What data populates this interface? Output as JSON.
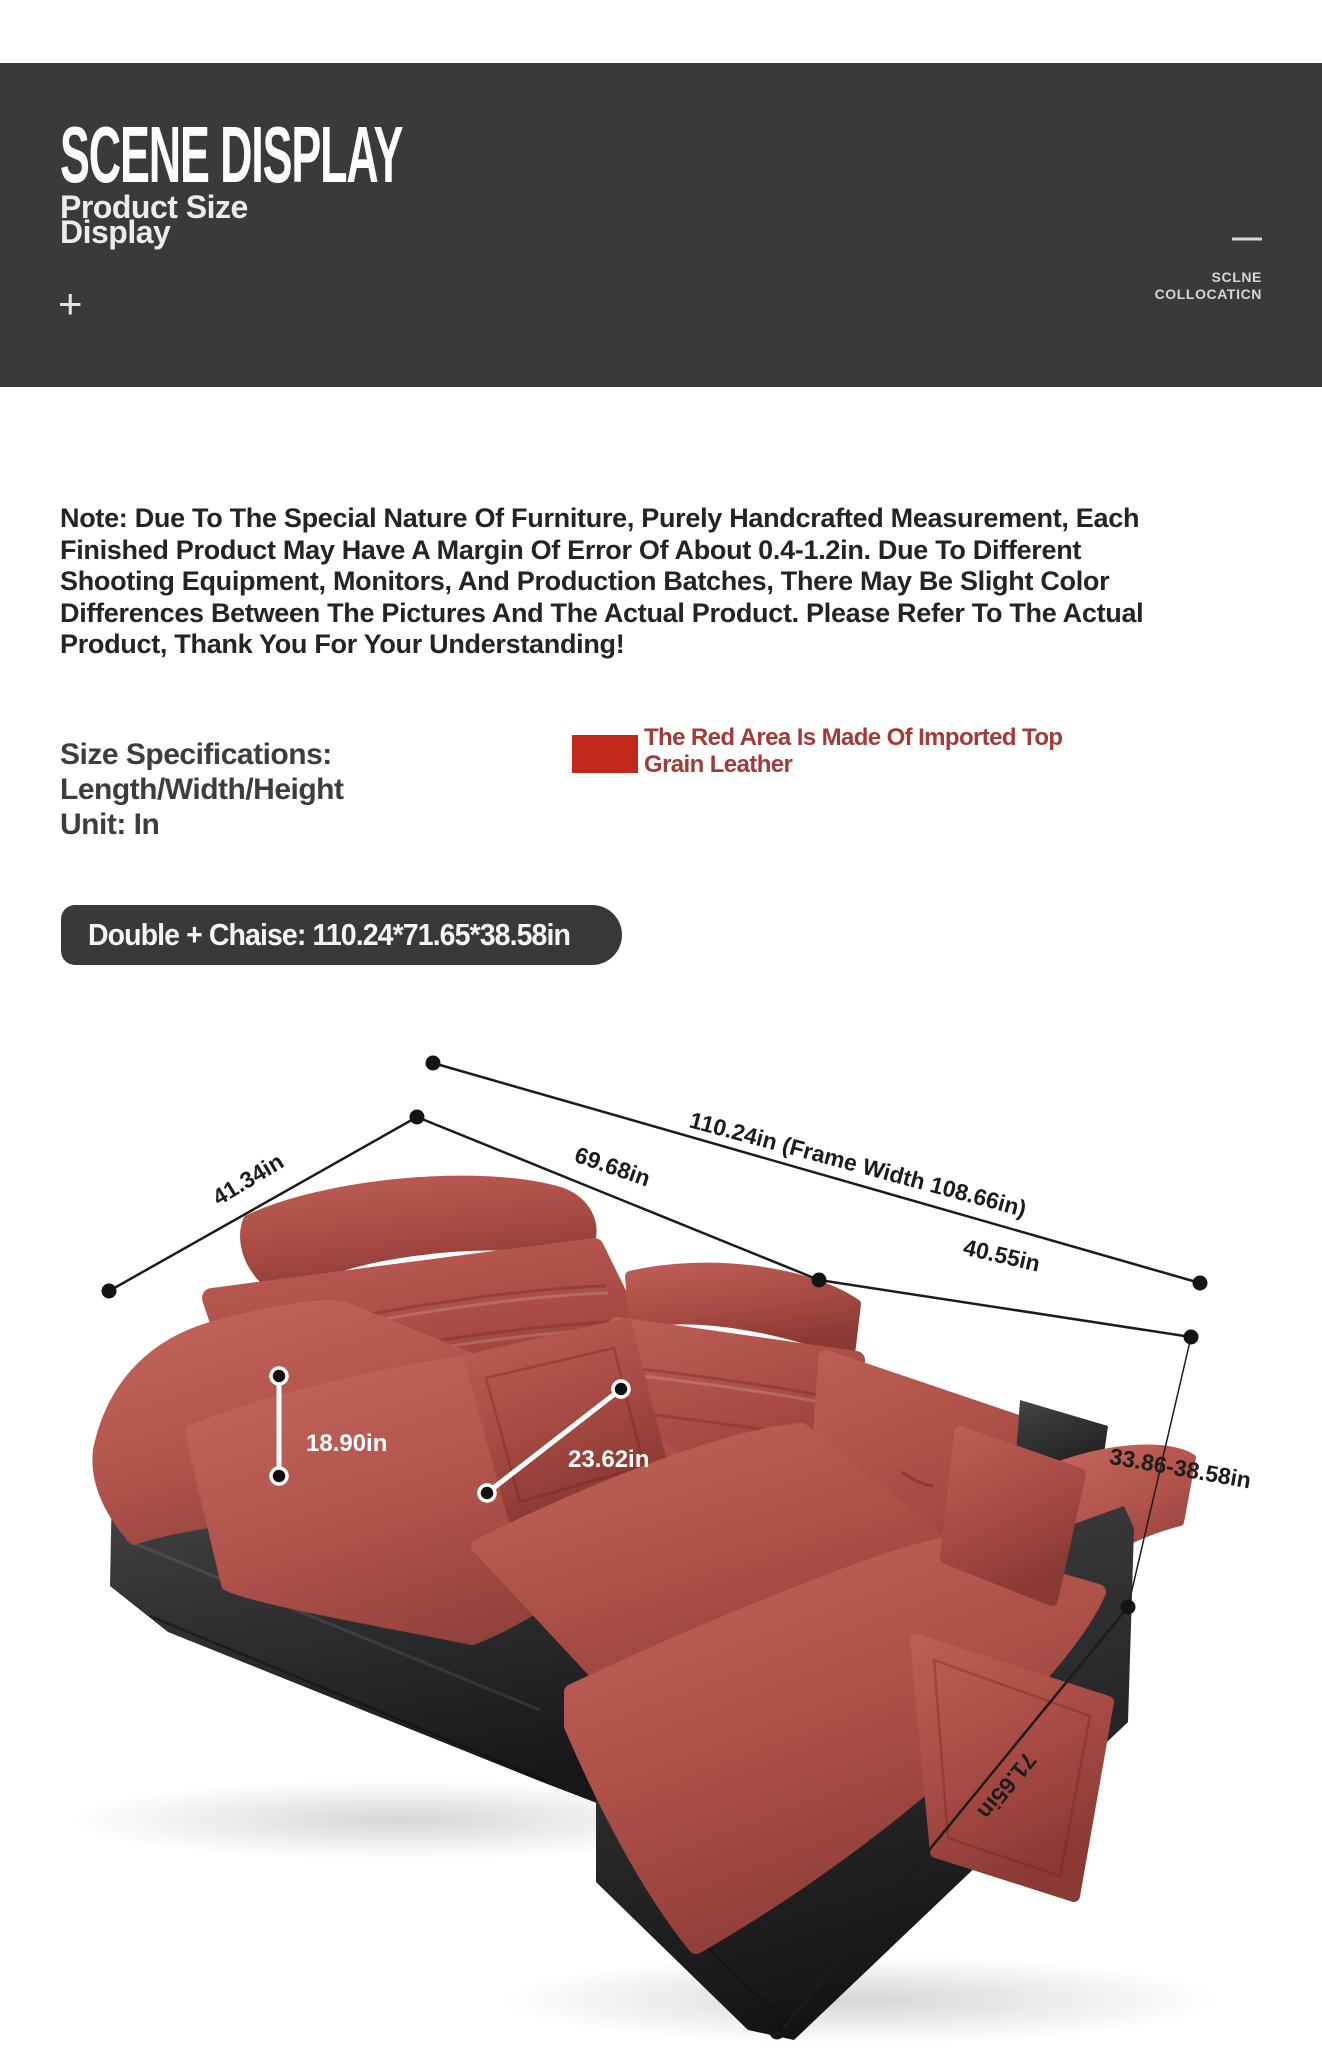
{
  "header": {
    "title": "SCENE DISPLAY",
    "subtitle_lines": [
      "Product Size",
      "Display"
    ],
    "plus_mark": "+",
    "minus_mark": "—",
    "corner_lines": [
      "SCLNE",
      "COLLOCATICN"
    ],
    "bg_color": "#3b3a3a"
  },
  "note": {
    "lines": [
      "Note: Due To The Special Nature Of Furniture, Purely Handcrafted Measurement, Each",
      "Finished Product May Have A Margin Of Error Of About 0.4-1.2in. Due To Different",
      "Shooting Equipment, Monitors, And Production Batches, There May Be Slight Color",
      "Differences Between The Pictures And The Actual Product. Please Refer To The Actual",
      "Product, Thank You For Your Understanding!"
    ]
  },
  "size_specs": {
    "lines": [
      "Size Specifications:",
      "Length/Width/Height",
      "Unit: In"
    ]
  },
  "leather_callout": {
    "lines": [
      "The Red Area Is Made Of Imported Top",
      "Grain Leather"
    ],
    "swatch_color": "#c2281c",
    "text_color": "#a33a3a"
  },
  "variant_badge": {
    "label": "Double + Chaise: 110.24*71.65*38.58in"
  },
  "diagram": {
    "labels": {
      "overall_width": "110.24in (Frame Width 108.66in)",
      "back_width_left": "69.68in",
      "side_depth": "41.34in",
      "back_width_right": "40.55in",
      "seat_height": "18.90in",
      "seat_depth": "23.62in",
      "back_height_range": "33.86-38.58in",
      "chaise_length": "71.65in"
    },
    "colors": {
      "leather_red": "#b2544c",
      "leather_red_light": "#c4675d",
      "leather_red_dark": "#8e3b35",
      "frame_dark": "#353537",
      "frame_dark_deep": "#1c1c1e",
      "annotation_line": "#1c1c1c"
    }
  }
}
